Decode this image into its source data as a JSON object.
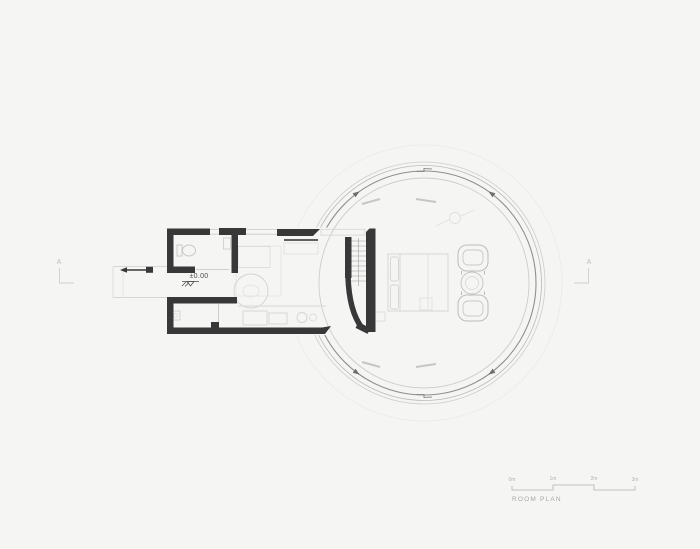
{
  "canvas": {
    "width": 700,
    "height": 549,
    "background": "#f5f5f4"
  },
  "drawing": {
    "type": "architectural-floor-plan",
    "title": "ROOM PLAN",
    "level_label": "±0.00",
    "section_markers": {
      "left": "A",
      "right": "A"
    },
    "scale_bar": {
      "labels": [
        "0m",
        "1m",
        "2m",
        "3m"
      ]
    },
    "colors": {
      "wall": "#383838",
      "track_arc": "#8f8f8d",
      "ring_line": "#b9b9b7",
      "inner_glass": "#cdcdcb",
      "faint_line": "#e4e4e2",
      "furniture": "#cfcfcd",
      "text_dark": "#4d4d4d",
      "text_gray": "#a8a8a6"
    }
  }
}
